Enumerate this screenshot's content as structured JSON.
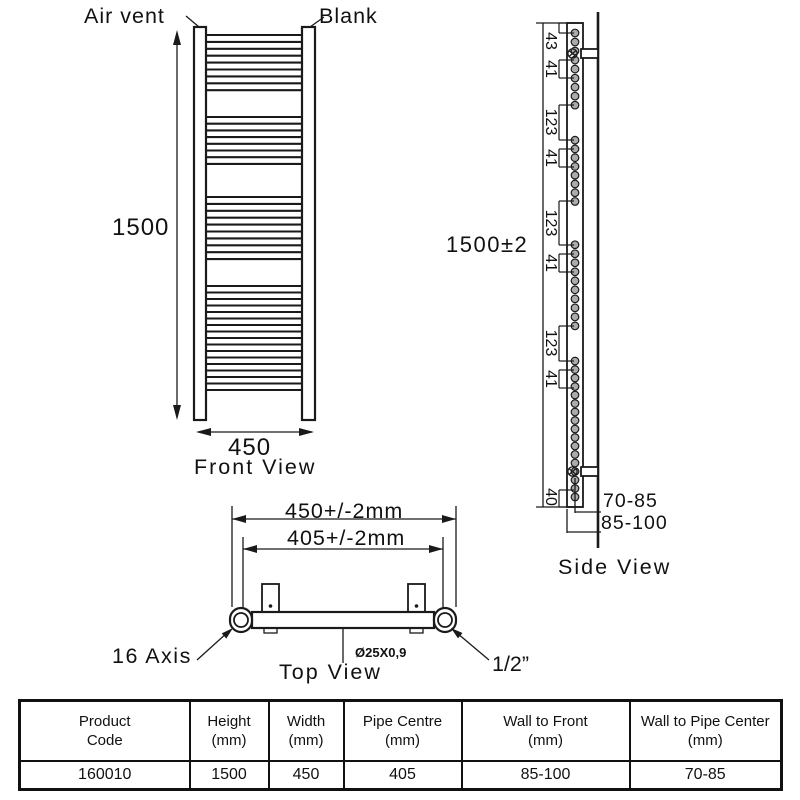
{
  "front_view": {
    "air_vent_label": "Air vent",
    "blank_label": "Blank",
    "height_label": "1500",
    "width_label": "450",
    "caption": "Front View",
    "bar_groups": [
      {
        "start": 35,
        "count": 9,
        "step": 6.9
      },
      {
        "start": 117,
        "count": 8,
        "step": 6.7
      },
      {
        "start": 197,
        "count": 10,
        "step": 6.9
      },
      {
        "start": 286,
        "count": 17,
        "step": 6.5
      }
    ]
  },
  "side_view": {
    "height_label": "1500±2",
    "wall_to_pipe_label": "70-85",
    "wall_to_front_label": "85-100",
    "caption": "Side View",
    "segments": [
      {
        "text": "43",
        "y1": 23,
        "y2": 33,
        "ly": 41
      },
      {
        "text": "41",
        "y1": 60,
        "y2": 78,
        "ly": 69
      },
      {
        "text": "123",
        "y1": 105,
        "y2": 140,
        "ly": 122
      },
      {
        "text": "41",
        "y1": 149,
        "y2": 167,
        "ly": 158
      },
      {
        "text": "123",
        "y1": 201,
        "y2": 245,
        "ly": 223
      },
      {
        "text": "41",
        "y1": 254,
        "y2": 272,
        "ly": 263
      },
      {
        "text": "123",
        "y1": 326,
        "y2": 361,
        "ly": 343
      },
      {
        "text": "41",
        "y1": 370,
        "y2": 388,
        "ly": 379
      },
      {
        "text": "40",
        "y1": 490,
        "y2": 507,
        "ly": 497
      }
    ]
  },
  "top_view": {
    "overall_width_label": "450+/-2mm",
    "pipe_centre_label": "405+/-2mm",
    "axis_label": "16 Axis",
    "pipe_size_label": "Ø25X0,9",
    "connection_label": "1/2”",
    "caption": "Top View"
  },
  "table": {
    "headers": [
      [
        "Product",
        "Code"
      ],
      [
        "Height",
        "(mm)"
      ],
      [
        "Width",
        "(mm)"
      ],
      [
        "Pipe Centre",
        "(mm)"
      ],
      [
        "Wall to Front",
        "(mm)"
      ],
      [
        "Wall to Pipe Center",
        "(mm)"
      ]
    ],
    "rows": [
      [
        "160010",
        "1500",
        "450",
        "405",
        "85-100",
        "70-85"
      ]
    ]
  },
  "colors": {
    "line": "#1a1a1a",
    "tube_fill": "#ababab",
    "bracket_fill": "#c4c4c4"
  }
}
